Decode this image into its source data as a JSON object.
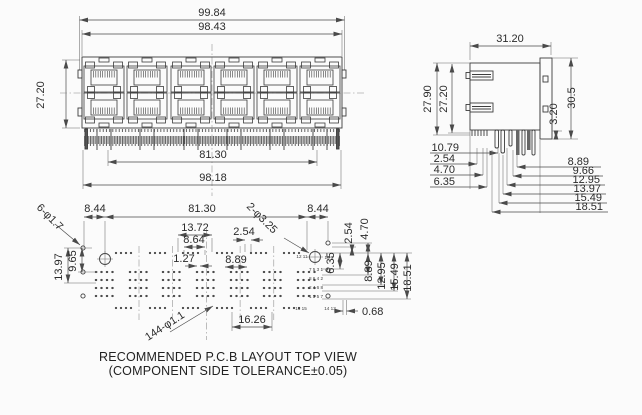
{
  "front_view": {
    "dim_overall_width": "99.84",
    "dim_body_width": "98.43",
    "dim_height": "27.20",
    "dim_pin_span": "81.30",
    "dim_outer_pin_span": "98.18"
  },
  "side_view": {
    "dim_depth": "31.20",
    "dim_height_outer": "27.90",
    "dim_height_body": "27.20",
    "dim_panel_tail": "3.20",
    "dim_height_total": "30.5",
    "stack_left": [
      "10.79",
      "2.54",
      "4.70",
      "6.35"
    ],
    "stack_right": [
      "8.89",
      "9.66",
      "12.95",
      "13.97",
      "15.49",
      "18.51"
    ]
  },
  "pcb": {
    "dim_margin_left": "8.44",
    "dim_span": "81.30",
    "dim_margin_right": "8.44",
    "callout_corner_holes": "6-φ1.7",
    "callout_center_holes": "2-φ3.25",
    "callout_pin_holes": "144-φ1.1",
    "dim_13_72": "13.72",
    "dim_8_64": "8.64",
    "dim_2_54_top": "2.54",
    "dim_1_27": "1.27",
    "dim_8_89_mid": "8.89",
    "dim_16_26": "16.26",
    "dim_0_68": "0.68",
    "v_2_54": "2.54",
    "v_4_70": "4.70",
    "v_6_35": "6.35",
    "v_8_89": "8.89",
    "v_12_95": "12.95",
    "v_15_49": "15.49",
    "v_18_51": "18.51",
    "l_13_97": "13.97",
    "l_9_65": "9.65",
    "pin_labels": [
      "12 11",
      "10 9",
      "7 5 3 1",
      "8 6 4 2",
      "2 4 6 8",
      "1 3 5 7",
      "16 15",
      "14 13"
    ]
  },
  "caption": {
    "line1": "RECOMMENDED P.C.B LAYOUT TOP VIEW",
    "line2": "(COMPONENT SIDE TOLERANCE±0.05)"
  }
}
